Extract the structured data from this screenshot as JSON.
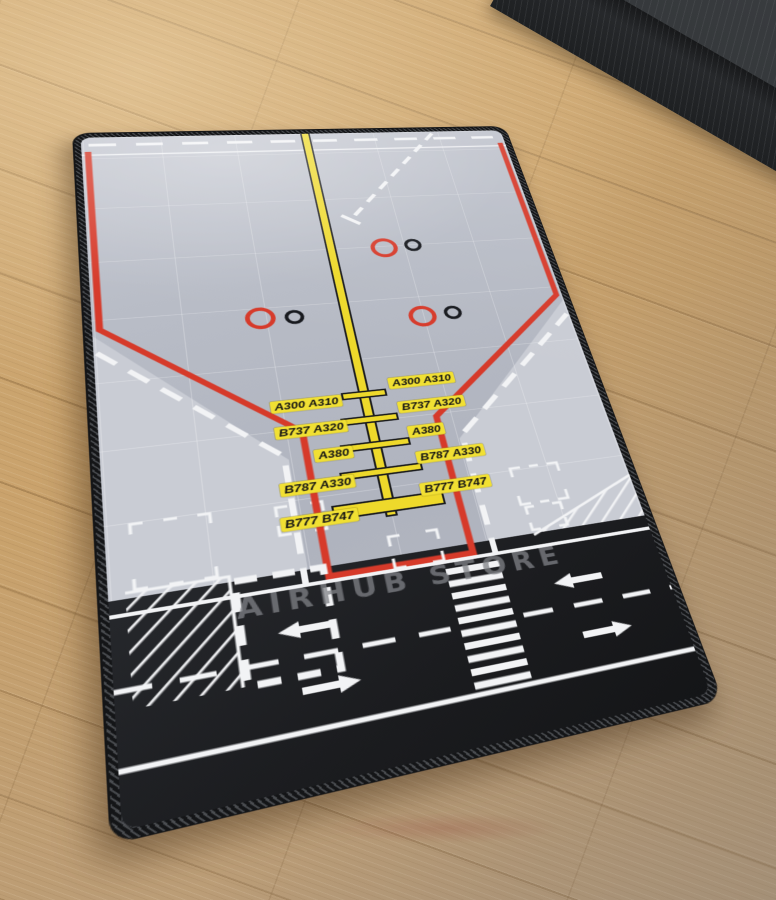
{
  "mat": {
    "watermark": "AIRHUB STORE",
    "stand_labels": {
      "left": [
        "A300 A310",
        "B737 A320",
        "A380",
        "B787 A330",
        "B777 B747"
      ],
      "right": [
        "A300 A310",
        "B737 A320",
        "A380",
        "B787 A330",
        "B777 B747"
      ]
    },
    "colors": {
      "apron_grey": "#b8bcc6",
      "apron_light_grey": "#c9ccd4",
      "safety_line_red": "#d63a2a",
      "centerline_yellow": "#eed92b",
      "label_yellow": "#f1e033",
      "road_black": "#1b1c1f",
      "marking_white": "#f2f3f5",
      "watermark_grey": "#808287",
      "edge_black": "#141517"
    }
  },
  "floor": {
    "wood_color": "#c8a26d"
  },
  "chalkboard": {
    "surface_color": "#34373a"
  }
}
